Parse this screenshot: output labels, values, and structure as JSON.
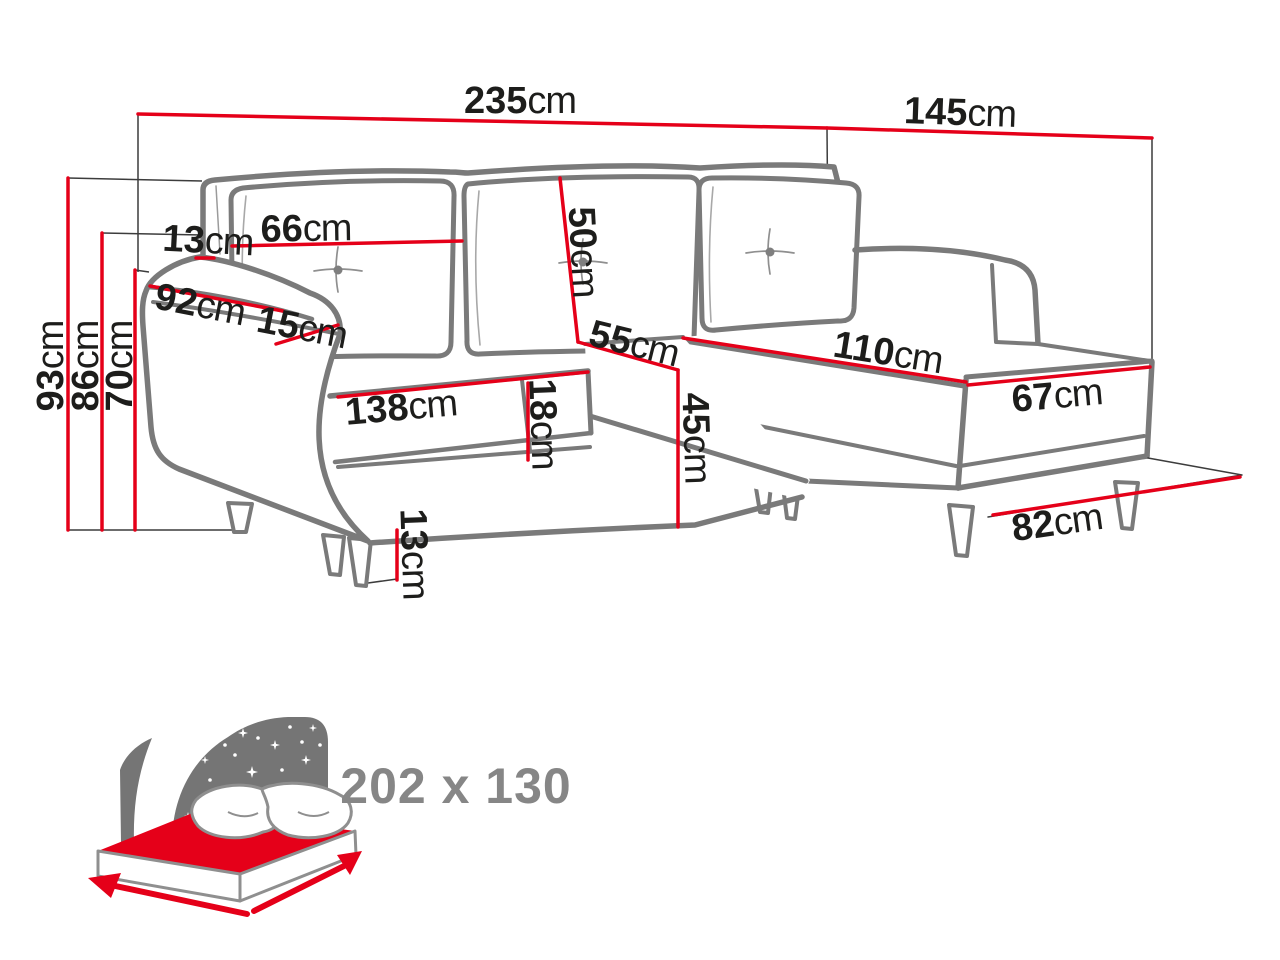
{
  "page": {
    "background": "#ffffff"
  },
  "colors": {
    "dimension_red": "#e50019",
    "outline_gray": "#7a7a7a",
    "thin_line_gray": "#3c3c3c",
    "label_black": "#1d1d1b",
    "icon_panel_gray": "#757575",
    "sleeping_text_gray": "#868686"
  },
  "dimension_labels": {
    "total_width": {
      "value": "235",
      "unit": "cm"
    },
    "total_depth": {
      "value": "145",
      "unit": "cm"
    },
    "back_height": {
      "value": "93",
      "unit": "cm"
    },
    "arm_height": {
      "value": "86",
      "unit": "cm"
    },
    "seat_back_height": {
      "value": "70",
      "unit": "cm"
    },
    "back_top_offset": {
      "value": "13",
      "unit": "cm"
    },
    "back_cushion_width": {
      "value": "66",
      "unit": "cm"
    },
    "back_cushion_height": {
      "value": "50",
      "unit": "cm"
    },
    "armrest_length": {
      "value": "92",
      "unit": "cm"
    },
    "armrest_width": {
      "value": "15",
      "unit": "cm"
    },
    "seat_depth": {
      "value": "55",
      "unit": "cm"
    },
    "chaise_length": {
      "value": "110",
      "unit": "cm"
    },
    "chaise_width": {
      "value": "67",
      "unit": "cm"
    },
    "seat_width": {
      "value": "138",
      "unit": "cm"
    },
    "seat_cushion_height": {
      "value": "18",
      "unit": "cm"
    },
    "seat_height": {
      "value": "45",
      "unit": "cm"
    },
    "leg_height": {
      "value": "13",
      "unit": "cm"
    },
    "chaise_floor_length": {
      "value": "82",
      "unit": "cm"
    }
  },
  "sleeping_function": {
    "icon": "sleeping-bed-icon",
    "size_label": "202 x 130"
  }
}
